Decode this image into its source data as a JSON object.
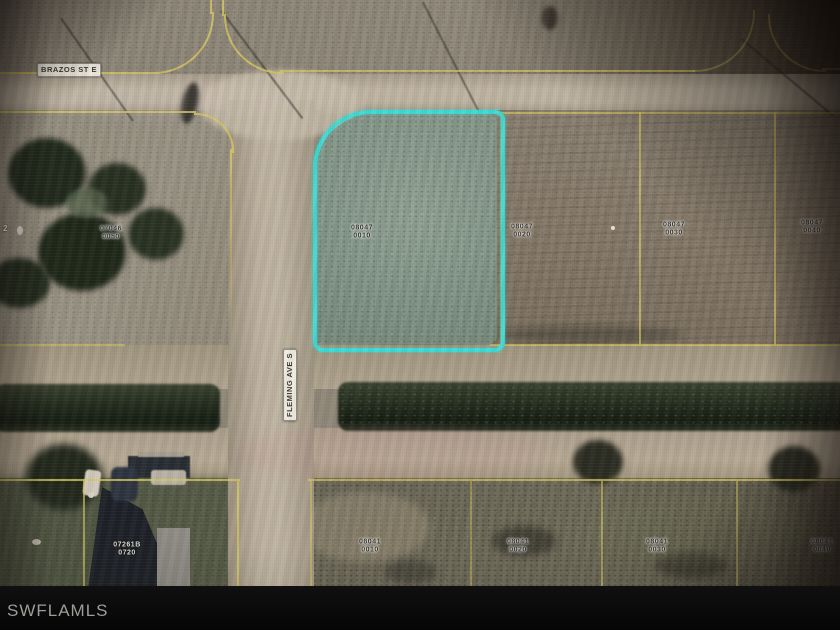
{
  "watermark": {
    "label": "SWFLAMLS"
  },
  "streets": [
    {
      "name": "BRAZOS ST E",
      "orientation": "horizontal",
      "x": 69,
      "y": 70
    },
    {
      "name": "FLEMING AVE S",
      "orientation": "vertical",
      "x": 290,
      "y": 385
    }
  ],
  "highlighted_parcel": {
    "label_line1": "08047",
    "label_line2": "0010"
  },
  "parcel_labels": [
    {
      "line1": "07046",
      "line2": "0050",
      "x": 111,
      "y": 233,
      "style": "dark"
    },
    {
      "line1": "08047",
      "line2": "0010",
      "x": 362,
      "y": 232,
      "style": "dark"
    },
    {
      "line1": "08047",
      "line2": "0020",
      "x": 522,
      "y": 231,
      "style": "dark"
    },
    {
      "line1": "08047",
      "line2": "0030",
      "x": 674,
      "y": 229,
      "style": "dark"
    },
    {
      "line1": "08047",
      "line2": "0040",
      "x": 812,
      "y": 227,
      "style": "dark"
    },
    {
      "line1": "08041",
      "line2": "0010",
      "x": 370,
      "y": 546,
      "style": "dark"
    },
    {
      "line1": "08041",
      "line2": "0020",
      "x": 518,
      "y": 546,
      "style": "dark"
    },
    {
      "line1": "08041",
      "line2": "0030",
      "x": 657,
      "y": 546,
      "style": "dark"
    },
    {
      "line1": "08041",
      "line2": "0040",
      "x": 822,
      "y": 546,
      "style": "dark"
    },
    {
      "line1": "07261B",
      "line2": "0720",
      "x": 127,
      "y": 549,
      "style": "light"
    }
  ],
  "edge_fragments": [
    {
      "text": "2",
      "x": 3,
      "y": 224
    }
  ],
  "colors": {
    "parcel_line": "#d9c95e",
    "highlight_outline": "#3edcd6",
    "watermark_text": "#a09c97"
  }
}
